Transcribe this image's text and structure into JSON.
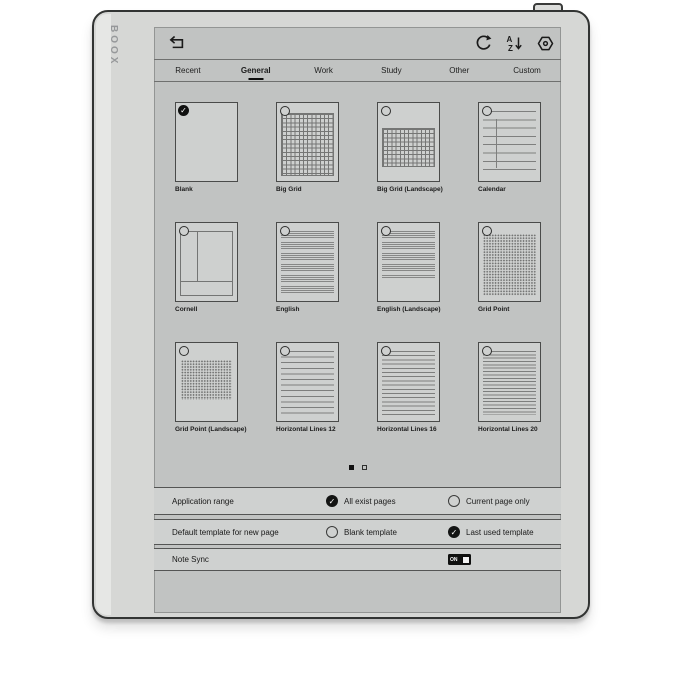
{
  "device": {
    "brand": "BOOX"
  },
  "toolbar": {
    "icons": [
      {
        "name": "back-icon"
      },
      {
        "name": "refresh-icon"
      },
      {
        "name": "sort-az-icon",
        "top_letter": "A",
        "bottom_letter": "Z"
      },
      {
        "name": "settings-icon"
      }
    ]
  },
  "tabs": [
    {
      "label": "Recent",
      "active": false
    },
    {
      "label": "General",
      "active": true
    },
    {
      "label": "Work",
      "active": false
    },
    {
      "label": "Study",
      "active": false
    },
    {
      "label": "Other",
      "active": false
    },
    {
      "label": "Custom",
      "active": false
    }
  ],
  "templates": {
    "items": [
      {
        "label": "Blank",
        "variant": "blank",
        "selected": true
      },
      {
        "label": "Big Grid",
        "variant": "big-grid",
        "selected": false
      },
      {
        "label": "Big Grid (Landscape)",
        "variant": "big-grid-landscape",
        "selected": false
      },
      {
        "label": "Calendar",
        "variant": "calendar",
        "selected": false
      },
      {
        "label": "Cornell",
        "variant": "cornell",
        "selected": false
      },
      {
        "label": "English",
        "variant": "english",
        "selected": false
      },
      {
        "label": "English (Landscape)",
        "variant": "english-landscape",
        "selected": false
      },
      {
        "label": "Grid Point",
        "variant": "grid-point",
        "selected": false
      },
      {
        "label": "Grid Point (Landscape)",
        "variant": "grid-point-landscape",
        "selected": false
      },
      {
        "label": "Horizontal Lines 12",
        "variant": "hlines-12",
        "selected": false
      },
      {
        "label": "Horizontal Lines 16",
        "variant": "hlines-16",
        "selected": false
      },
      {
        "label": "Horizontal Lines 20",
        "variant": "hlines-20",
        "selected": false
      }
    ],
    "pagination": {
      "pages": 2,
      "active_page": 1
    }
  },
  "settings": {
    "rows": [
      {
        "label": "Application range",
        "options": [
          {
            "label": "All exist pages",
            "checked": true
          },
          {
            "label": "Current page only",
            "checked": false
          }
        ]
      },
      {
        "label": "Default template for new page",
        "options": [
          {
            "label": "Blank template",
            "checked": false
          },
          {
            "label": "Last used template",
            "checked": true
          }
        ]
      },
      {
        "label": "Note Sync",
        "toggle": {
          "label": "ON",
          "state": "on"
        }
      }
    ]
  },
  "colors": {
    "accent": "#101110",
    "screen_bg": "#c1c3c2",
    "bezel": "#d6d7d5",
    "card_bg": "#ced0cf"
  }
}
